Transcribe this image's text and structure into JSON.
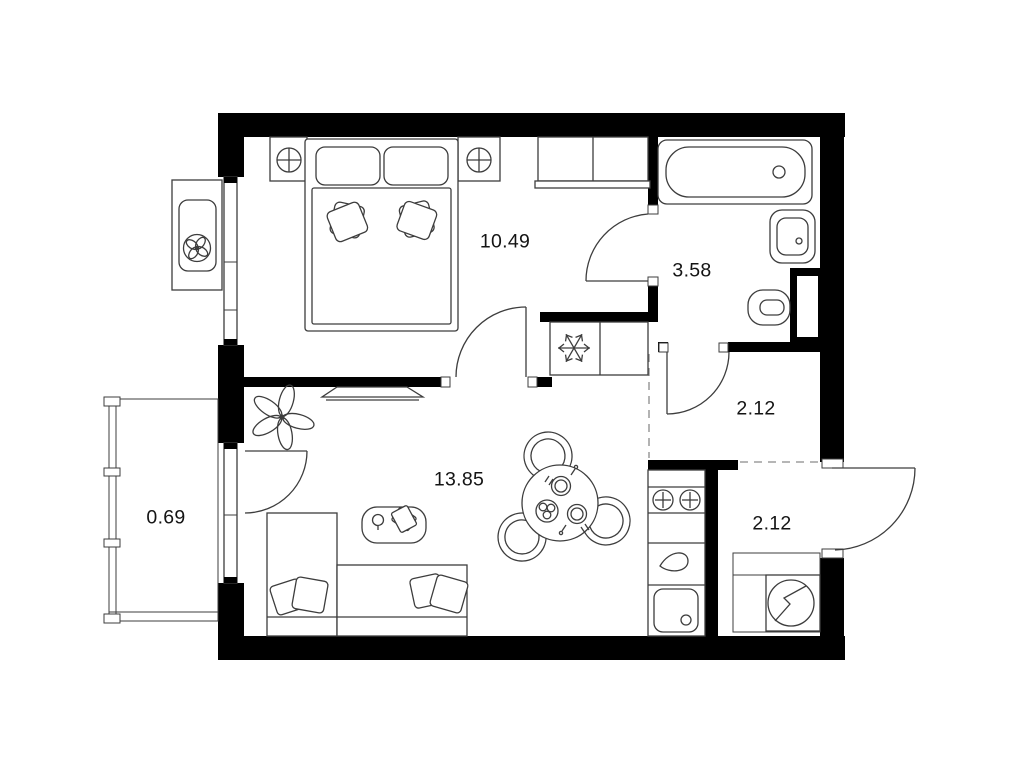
{
  "floor_plan": {
    "rooms": {
      "bedroom": {
        "area": "10.49"
      },
      "bathroom": {
        "area": "3.58"
      },
      "hallway_upper": {
        "area": "2.12"
      },
      "hallway_entry": {
        "area": "2.12"
      },
      "living_room": {
        "area": "13.85"
      },
      "balcony": {
        "area": "0.69"
      }
    },
    "icons": {
      "air_conditioner": "fan-icon",
      "fridge": "snowflake-icon",
      "washing_machine": "circle-zigzag-icon",
      "stove": "two-burner-icon",
      "bathroom_fixtures": "bathtub, wash-basin, toilet",
      "living_fixtures": "sofa, coffee-table, dining-table, tv, plant",
      "bedroom_fixtures": "double-bed, nightstands, wardrobe"
    },
    "colors": {
      "wall": "#000000",
      "line": "#3d3d3d",
      "text": "#141414",
      "background": "#ffffff"
    }
  }
}
